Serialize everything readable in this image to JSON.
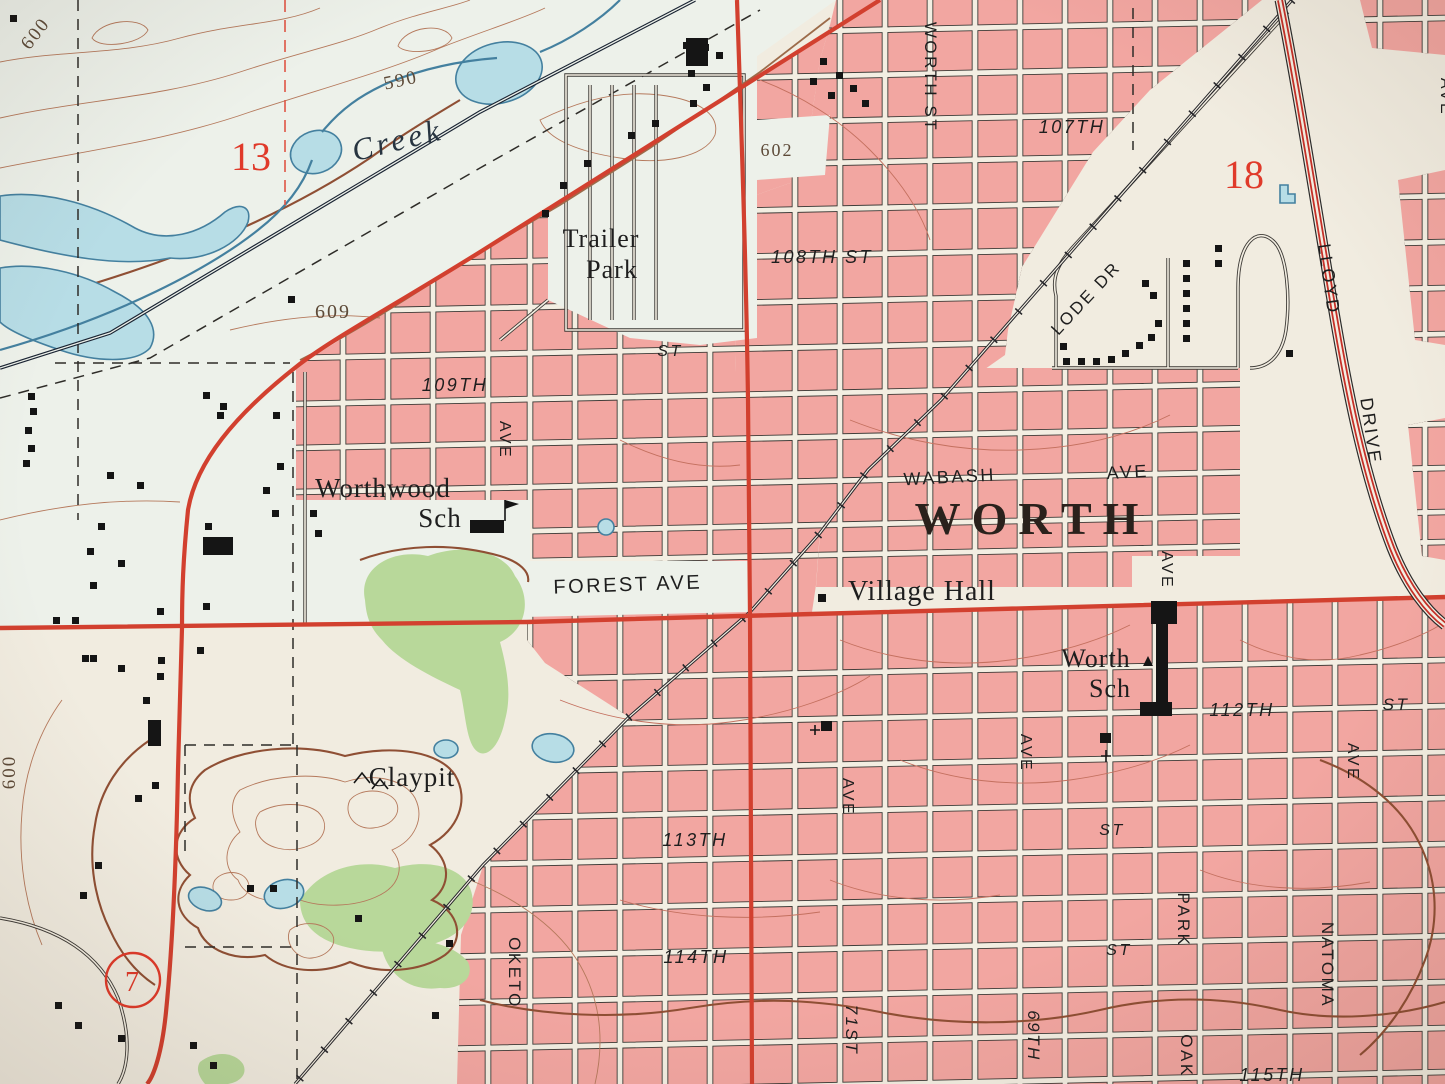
{
  "map": {
    "kind": "topographic-map-photo",
    "city_label": "WORTH",
    "labels": [
      {
        "n": "contour-600-nw",
        "t": "600",
        "x": 40,
        "y": 37,
        "r": -52,
        "s": 19,
        "c": "contour"
      },
      {
        "n": "contour-590",
        "t": "590",
        "x": 402,
        "y": 86,
        "r": -12,
        "s": 19,
        "c": "contour"
      },
      {
        "n": "section-13",
        "t": "13",
        "x": 251,
        "y": 170,
        "r": 0,
        "s": 40,
        "c": "red"
      },
      {
        "n": "creek-name",
        "t": "Creek",
        "x": 400,
        "y": 150,
        "r": -14,
        "s": 31,
        "c": "water"
      },
      {
        "n": "contour-609",
        "t": "609",
        "x": 333,
        "y": 318,
        "r": 0,
        "s": 20,
        "c": "contour"
      },
      {
        "n": "contour-602",
        "t": "602",
        "x": 777,
        "y": 156,
        "r": 0,
        "s": 18,
        "c": "contour"
      },
      {
        "n": "trailer-park-1",
        "t": "Trailer",
        "x": 601,
        "y": 247,
        "r": 0,
        "s": 26,
        "c": "place"
      },
      {
        "n": "trailer-park-2",
        "t": "Park",
        "x": 612,
        "y": 278,
        "r": 0,
        "s": 26,
        "c": "place"
      },
      {
        "n": "st-108",
        "t": "108TH ST",
        "x": 822,
        "y": 263,
        "r": 0,
        "s": 18,
        "c": "street-i"
      },
      {
        "n": "worth-st",
        "t": "WORTH ST",
        "x": 925,
        "y": 77,
        "r": 90,
        "s": 17,
        "c": "street"
      },
      {
        "n": "st-107",
        "t": "107TH",
        "x": 1072,
        "y": 133,
        "r": 0,
        "s": 18,
        "c": "street-i"
      },
      {
        "n": "section-18",
        "t": "18",
        "x": 1244,
        "y": 188,
        "r": 0,
        "s": 40,
        "c": "red"
      },
      {
        "n": "lode-dr",
        "t": "LODE DR",
        "x": 1090,
        "y": 302,
        "r": -47,
        "s": 17,
        "c": "street"
      },
      {
        "n": "lloyd",
        "t": "LLOYD",
        "x": 1323,
        "y": 280,
        "r": 82,
        "s": 18,
        "c": "street"
      },
      {
        "n": "drive",
        "t": "DRIVE",
        "x": 1365,
        "y": 432,
        "r": 82,
        "s": 18,
        "c": "street"
      },
      {
        "n": "st-mid",
        "t": "ST",
        "x": 670,
        "y": 356,
        "r": 0,
        "s": 16,
        "c": "street-i"
      },
      {
        "n": "st-109",
        "t": "109TH",
        "x": 455,
        "y": 391,
        "r": 0,
        "s": 18,
        "c": "street-i"
      },
      {
        "n": "ave-109",
        "t": "AVE",
        "x": 500,
        "y": 440,
        "r": 90,
        "s": 16,
        "c": "street"
      },
      {
        "n": "worthwood-1",
        "t": "Worthwood",
        "x": 383,
        "y": 497,
        "r": 0,
        "s": 27,
        "c": "place"
      },
      {
        "n": "worthwood-2",
        "t": "Sch",
        "x": 440,
        "y": 527,
        "r": 0,
        "s": 27,
        "c": "place"
      },
      {
        "n": "wabash",
        "t": "WABASH",
        "x": 950,
        "y": 483,
        "r": -3,
        "s": 18,
        "c": "street"
      },
      {
        "n": "wabash-ave",
        "t": "AVE",
        "x": 1128,
        "y": 478,
        "r": -3,
        "s": 18,
        "c": "street"
      },
      {
        "n": "worth-city",
        "t": "WORTH",
        "x": 1032,
        "y": 534,
        "r": 0,
        "s": 46,
        "c": "city"
      },
      {
        "n": "village-hall",
        "t": "Village Hall",
        "x": 922,
        "y": 600,
        "r": 0,
        "s": 28,
        "c": "place"
      },
      {
        "n": "forest-ave",
        "t": "FOREST AVE",
        "x": 628,
        "y": 591,
        "r": -2,
        "s": 20,
        "c": "street"
      },
      {
        "n": "ave-worth-sch",
        "t": "AVE",
        "x": 1162,
        "y": 570,
        "r": 90,
        "s": 16,
        "c": "street"
      },
      {
        "n": "worth-sch-1",
        "t": "Worth",
        "x": 1096,
        "y": 667,
        "r": 0,
        "s": 26,
        "c": "place"
      },
      {
        "n": "worth-sch-2",
        "t": "Sch",
        "x": 1110,
        "y": 697,
        "r": 0,
        "s": 26,
        "c": "place"
      },
      {
        "n": "st-112",
        "t": "112TH",
        "x": 1242,
        "y": 716,
        "r": 0,
        "s": 18,
        "c": "street-i"
      },
      {
        "n": "st-112-st",
        "t": "ST",
        "x": 1396,
        "y": 710,
        "r": 0,
        "s": 17,
        "c": "street-i"
      },
      {
        "n": "ave-71",
        "t": "AVE",
        "x": 843,
        "y": 797,
        "r": 90,
        "s": 16,
        "c": "street"
      },
      {
        "n": "st-113",
        "t": "113TH",
        "x": 695,
        "y": 846,
        "r": 0,
        "s": 18,
        "c": "street-i"
      },
      {
        "n": "st-113-st",
        "t": "ST",
        "x": 1112,
        "y": 835,
        "r": 0,
        "s": 16,
        "c": "street-i"
      },
      {
        "n": "st-114",
        "t": "114TH",
        "x": 696,
        "y": 963,
        "r": 0,
        "s": 18,
        "c": "street-i"
      },
      {
        "n": "st-114-st",
        "t": "ST",
        "x": 1119,
        "y": 955,
        "r": 0,
        "s": 16,
        "c": "street-i"
      },
      {
        "n": "oketo",
        "t": "OKETO",
        "x": 509,
        "y": 973,
        "r": 90,
        "s": 17,
        "c": "street"
      },
      {
        "n": "71st",
        "t": "71ST",
        "x": 846,
        "y": 1030,
        "r": 90,
        "s": 17,
        "c": "street-i"
      },
      {
        "n": "69th",
        "t": "69TH",
        "x": 1028,
        "y": 1036,
        "r": 90,
        "s": 17,
        "c": "street-i"
      },
      {
        "n": "ave-69",
        "t": "AVE",
        "x": 1021,
        "y": 753,
        "r": 90,
        "s": 16,
        "c": "street"
      },
      {
        "n": "park",
        "t": "PARK",
        "x": 1178,
        "y": 920,
        "r": 90,
        "s": 17,
        "c": "street"
      },
      {
        "n": "oak",
        "t": "OAK",
        "x": 1181,
        "y": 1056,
        "r": 90,
        "s": 17,
        "c": "street"
      },
      {
        "n": "natoma",
        "t": "NATOMA",
        "x": 1322,
        "y": 965,
        "r": 90,
        "s": 17,
        "c": "street"
      },
      {
        "n": "ave-natoma",
        "t": "AVE",
        "x": 1348,
        "y": 762,
        "r": 90,
        "s": 16,
        "c": "street"
      },
      {
        "n": "st-115",
        "t": "115TH",
        "x": 1272,
        "y": 1081,
        "r": 0,
        "s": 18,
        "c": "street-i"
      },
      {
        "n": "claypit",
        "t": "Claypit",
        "x": 412,
        "y": 786,
        "r": 0,
        "s": 27,
        "c": "place"
      },
      {
        "n": "section-7",
        "t": "7",
        "x": 132,
        "y": 991,
        "r": 0,
        "s": 28,
        "c": "red"
      },
      {
        "n": "contour-600-w",
        "t": "600",
        "x": 15,
        "y": 772,
        "r": -90,
        "s": 19,
        "c": "contour"
      },
      {
        "n": "ave-edge",
        "t": "AVE",
        "x": 1441,
        "y": 97,
        "r": 90,
        "s": 16,
        "c": "street"
      }
    ]
  },
  "colors": {
    "paper": "#f1ece0",
    "floodplain": "#edf1ea",
    "urban_pink": "#f2a6a1",
    "water_fill": "#b7dde6",
    "water_line": "#44809f",
    "woodland_green": "#b8d89a",
    "road_red": "#d2402f",
    "rail_dark": "#26262a",
    "street_fill": "#f3eee2",
    "street_case": "#3d3a36",
    "contour": "#b5795c",
    "contour_index": "#8f4f34",
    "contour_pink": "#c4705f",
    "ink": "#1e1e1e",
    "label_red": "#e03a2a"
  }
}
